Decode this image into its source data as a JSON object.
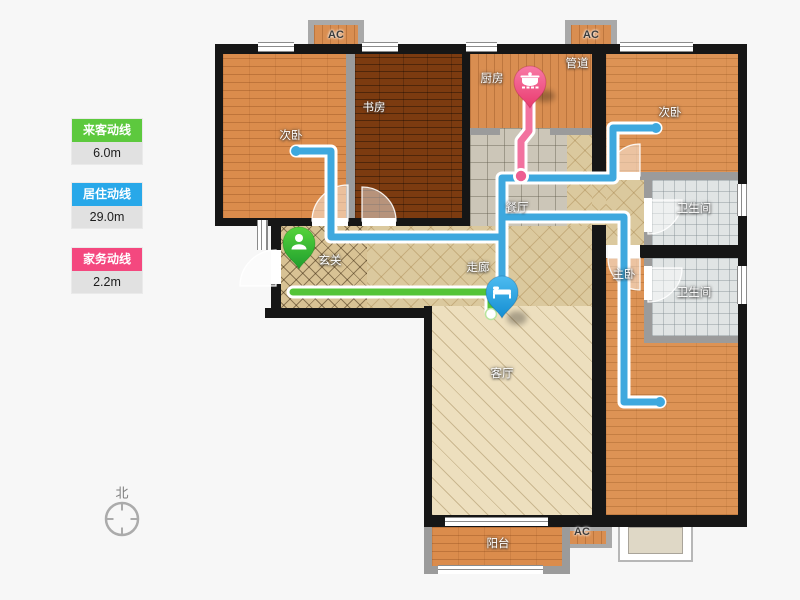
{
  "legend": {
    "items": [
      {
        "label": "来客动线",
        "value": "6.0m",
        "color": "#5dc93e"
      },
      {
        "label": "居住动线",
        "value": "29.0m",
        "color": "#28a8e9"
      },
      {
        "label": "家务动线",
        "value": "2.2m",
        "color": "#f4487f"
      }
    ]
  },
  "compass": {
    "north_label": "北"
  },
  "rooms": {
    "bedroom_tl": "次卧",
    "study": "书房",
    "kitchen": "厨房",
    "duct": "管道",
    "bedroom_tr": "次卧",
    "bathroom_top": "卫生间",
    "dining": "餐厅",
    "corridor": "走廊",
    "entry": "玄关",
    "master": "主卧",
    "bathroom_bottom": "卫生间",
    "living": "客厅",
    "balcony": "阳台"
  },
  "hvac": {
    "ac_label": "AC"
  },
  "pins": [
    {
      "icon": "person-icon",
      "route": "来客动线",
      "color": "#35b53e"
    },
    {
      "icon": "pot-icon",
      "route": "家务动线",
      "color": "#ee4f80"
    },
    {
      "icon": "bed-icon",
      "route": "居住动线",
      "color": "#2ea6e4"
    }
  ],
  "route_colors": {
    "visitor": "#55c438",
    "living": "#3ea8de",
    "housework": "#f2729f"
  }
}
